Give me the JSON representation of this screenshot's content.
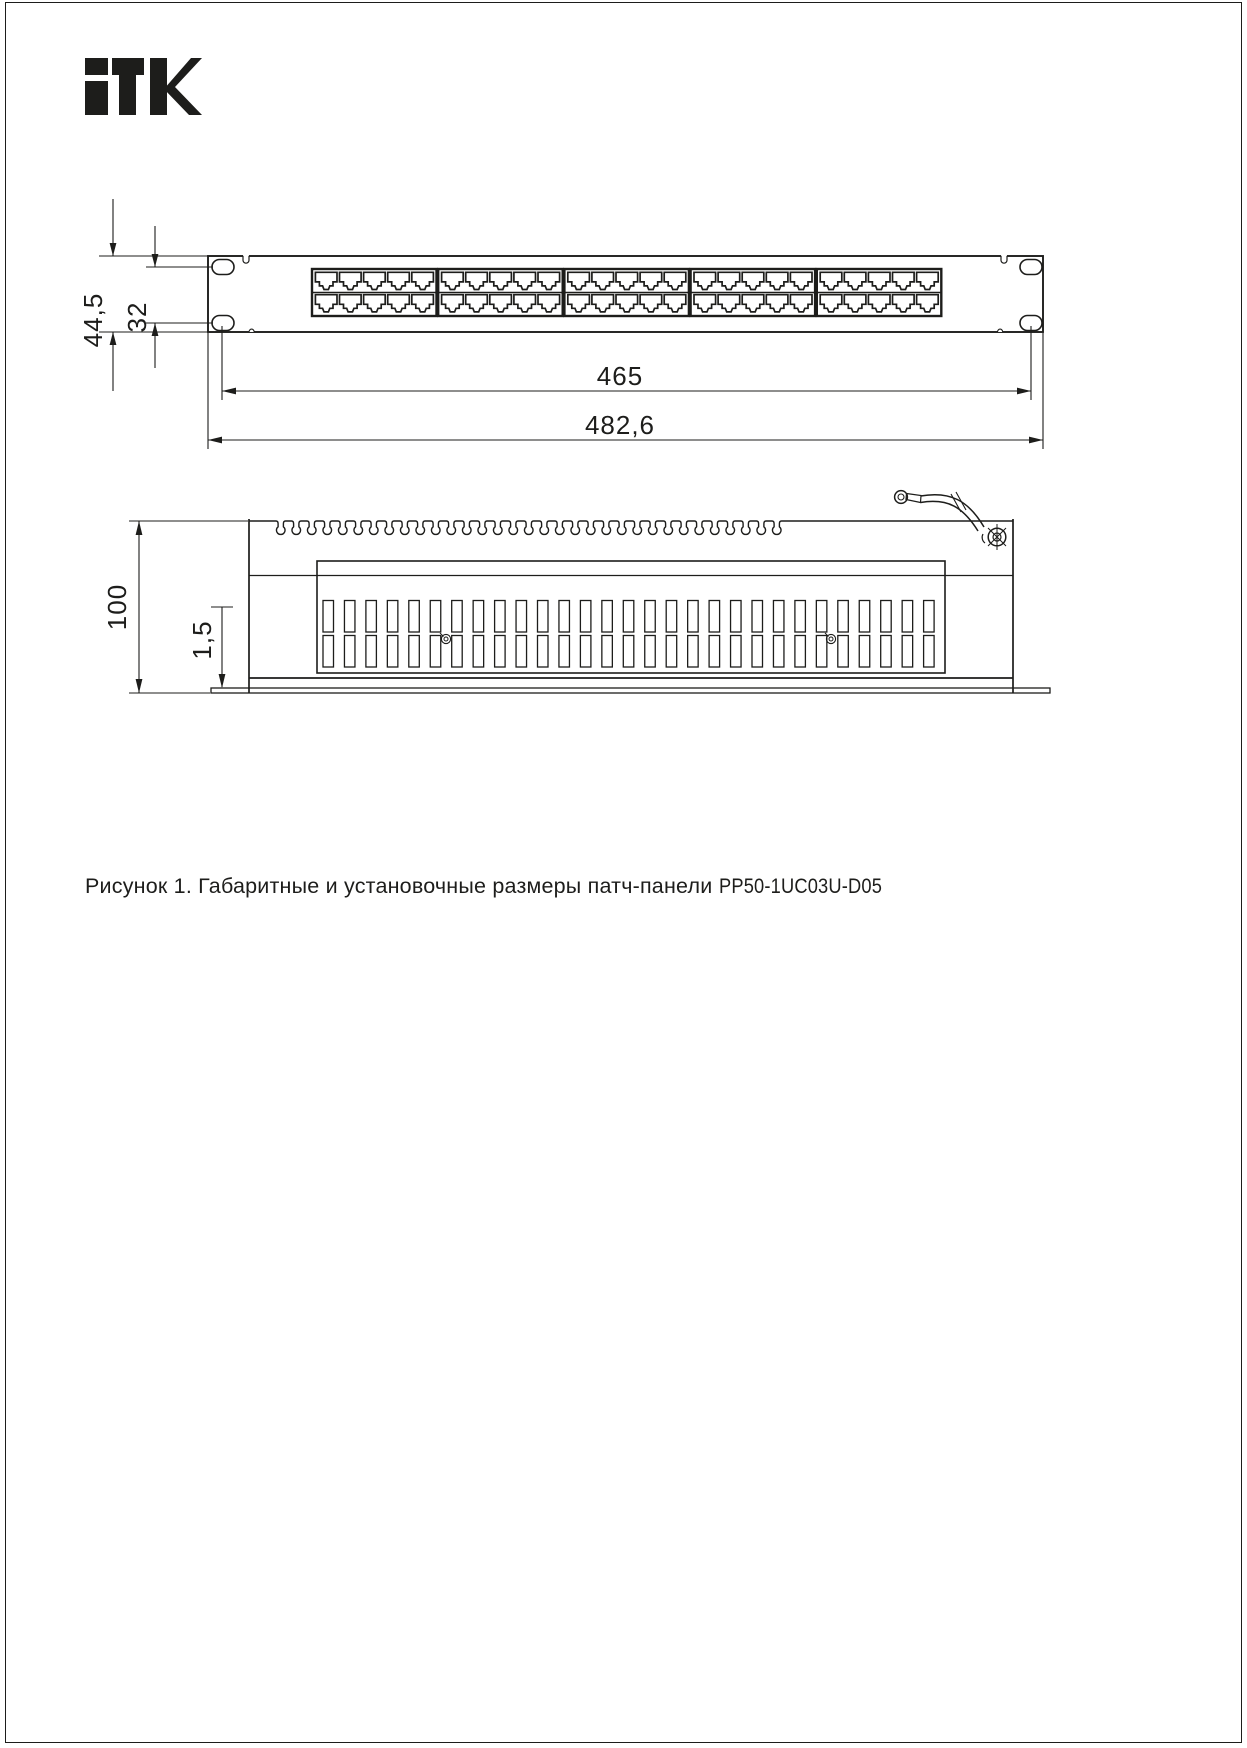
{
  "brand": {
    "logo_text": "ITK"
  },
  "figure": {
    "caption_prefix": "Рисунок 1. Габаритные и установочные размеры патч-панели ",
    "model": "PP50-1UC03U-D05"
  },
  "front_view": {
    "dim_overall_height": "44,5",
    "dim_hole_offset": "32",
    "dim_mount_hole_span": "465",
    "dim_overall_width": "482,6",
    "port_groups": 5,
    "port_columns_per_group": 5,
    "port_rows": 2,
    "total_ports": 50
  },
  "side_view": {
    "dim_overall_depth": "100",
    "dim_panel_thickness": "1,5"
  },
  "colors": {
    "line": "#1d1d1b",
    "paper": "#ffffff"
  }
}
